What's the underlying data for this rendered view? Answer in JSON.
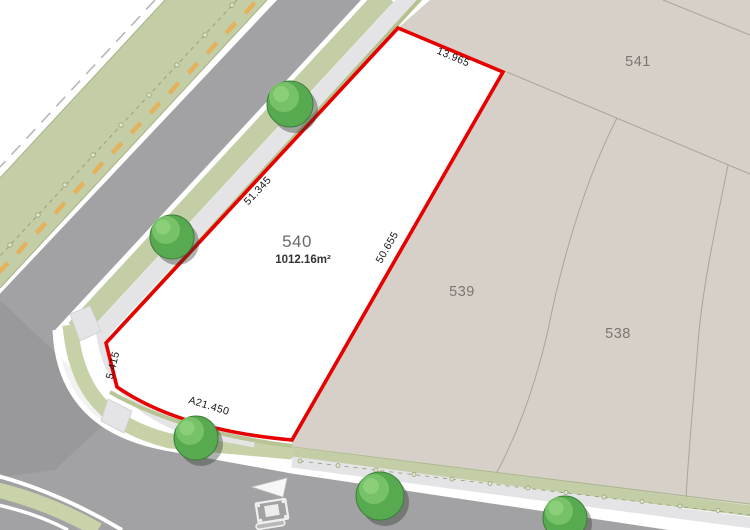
{
  "plan": {
    "featured_lot": {
      "number": "540",
      "area": "1012.16m²"
    },
    "neighbor_lots": {
      "top": "541",
      "middle": "539",
      "right": "538"
    },
    "dimensions": {
      "top": "13.965",
      "left": "51.345",
      "right": "50.655",
      "splay": "5.415",
      "bottom_arc": "A21.450"
    },
    "colors": {
      "boundary_red": "#e60000",
      "lot_fill": "#ffffff",
      "parcel_beige": "#d7d0c9",
      "road_gray": "#a2a2a4",
      "verge_green": "#c3cda6",
      "corner_verge_green": "#c7d1a8",
      "path_gray": "#e4e4e6",
      "marker_yellow": "#e5b25b",
      "tree_green": "#57aa50"
    }
  }
}
